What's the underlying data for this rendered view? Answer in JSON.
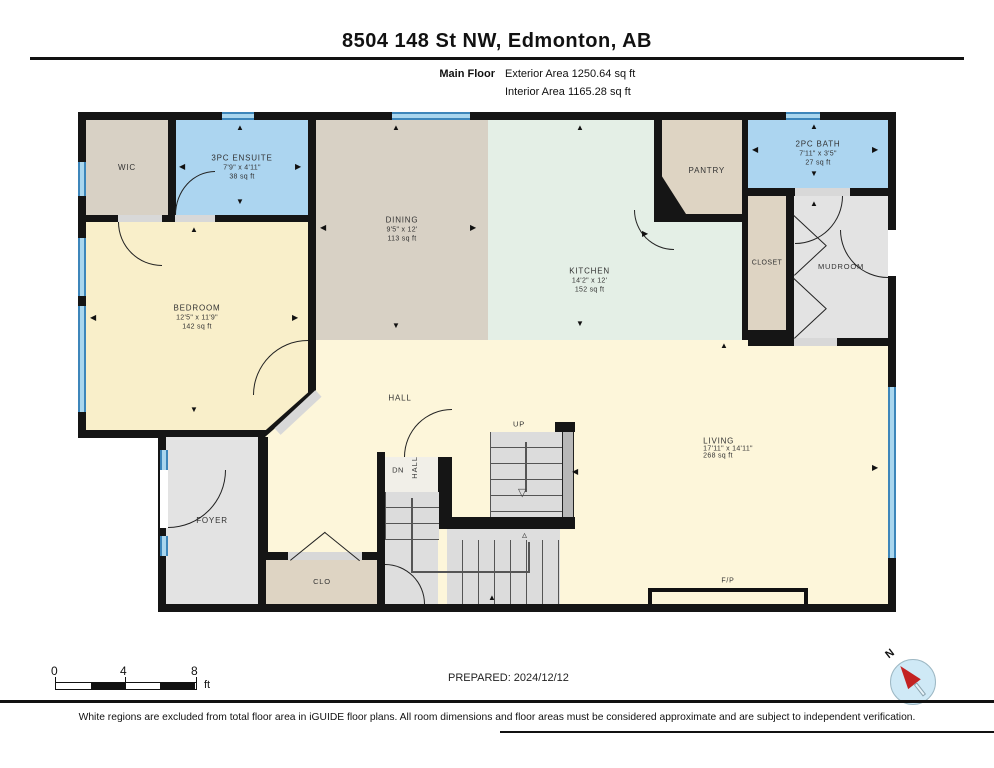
{
  "header": {
    "title": "8504 148 St NW, Edmonton, AB",
    "floor_label": "Main Floor",
    "exterior_area": "Exterior Area 1250.64 sq ft",
    "interior_area": "Interior Area 1165.28 sq ft"
  },
  "rooms": {
    "wic": {
      "name": "WIC"
    },
    "ensuite": {
      "name": "3PC ENSUITE",
      "dims": "7'9\" x 4'11\"",
      "area": "38 sq ft"
    },
    "dining": {
      "name": "DINING",
      "dims": "9'5\" x 12'",
      "area": "113 sq ft"
    },
    "kitchen": {
      "name": "KITCHEN",
      "dims": "14'2\" x 12'",
      "area": "152 sq ft"
    },
    "pantry": {
      "name": "PANTRY"
    },
    "bath": {
      "name": "2PC BATH",
      "dims": "7'11\" x 3'5\"",
      "area": "27 sq ft"
    },
    "closet": {
      "name": "CLOSET"
    },
    "mudroom": {
      "name": "MUDROOM"
    },
    "bedroom": {
      "name": "BEDROOM",
      "dims": "12'5\" x 11'9\"",
      "area": "142 sq ft"
    },
    "hall": {
      "name": "HALL"
    },
    "foyer": {
      "name": "FOYER"
    },
    "clo": {
      "name": "CLO"
    },
    "living": {
      "name": "LIVING",
      "dims": "17'11\" x 14'11\"",
      "area": "268 sq ft"
    },
    "fireplace": {
      "name": "F/P"
    }
  },
  "stairs": {
    "up": "UP",
    "dn": "DN",
    "hall": "HALL"
  },
  "scale_bar": {
    "tick0": "0",
    "tick1": "4",
    "tick2": "8",
    "unit": "ft"
  },
  "prepared": "PREPARED: 2024/12/12",
  "compass": {
    "label": "N"
  },
  "footer": "White regions are excluded from total floor area in iGUIDE floor plans. All room dimensions and floor areas must be considered approximate and are subject to independent verification.",
  "colors": {
    "wall": "#151515",
    "cream": "#fdf6da",
    "bedroom_cream": "#f9efca",
    "tan": "#d8d1c5",
    "beige": "#ded4c3",
    "blue_room": "#acd5f0",
    "green_room": "#e4efe6",
    "gray_room": "#e3e3e3",
    "window_blue": "#5aa7d8",
    "compass_red": "#c32222"
  }
}
